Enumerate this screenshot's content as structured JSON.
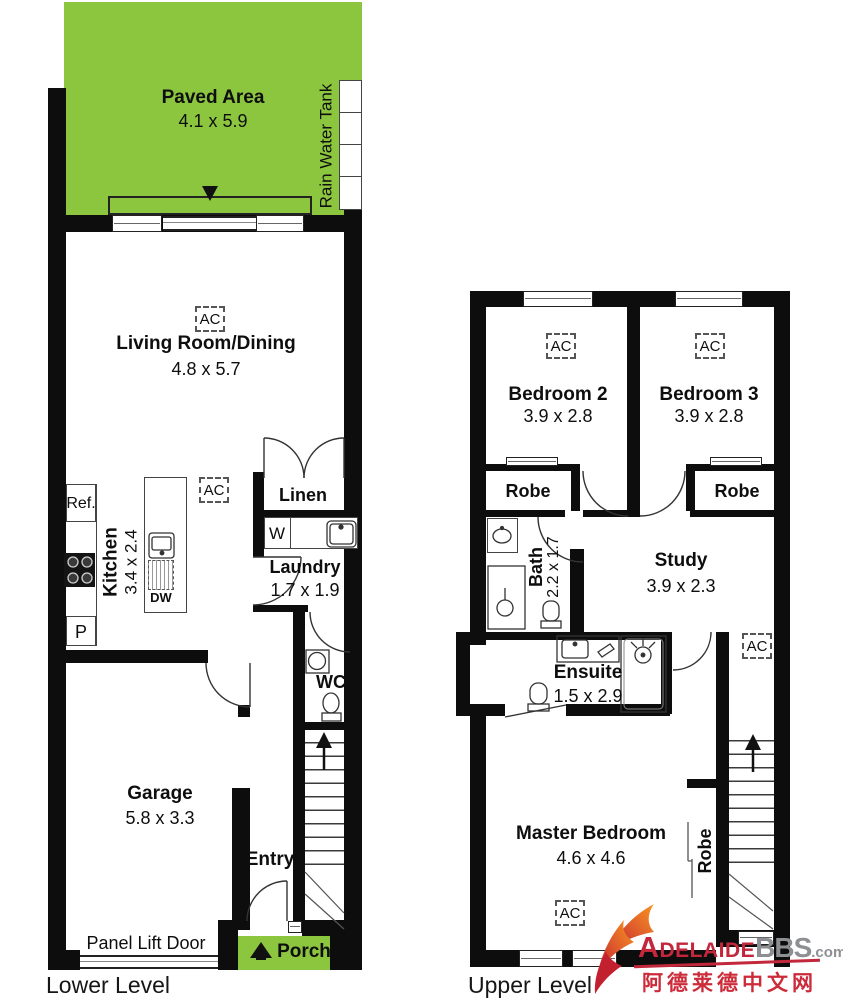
{
  "colors": {
    "green": "#8CC63F",
    "wall": "#0d0d0d",
    "logo_red": "#C2273C",
    "logo_gray": "#8D8F92",
    "chinese_red": "#CC2B3A"
  },
  "shared": {
    "ac_label": "AC"
  },
  "lower": {
    "caption": "Lower Level",
    "paved": {
      "name": "Paved Area",
      "dims": "4.1 x 5.9"
    },
    "tank": {
      "label": "Rain Water Tank"
    },
    "living": {
      "name": "Living Room/Dining",
      "dims": "4.8 x 5.7"
    },
    "kitchen": {
      "name": "Kitchen",
      "dims": "3.4 x 2.4",
      "fridge": "Ref.",
      "pantry": "P",
      "dishwasher": "DW"
    },
    "linen": {
      "name": "Linen"
    },
    "laundry": {
      "name": "Laundry",
      "dims": "1.7 x 1.9",
      "washer": "W"
    },
    "wc": {
      "name": "WC"
    },
    "garage": {
      "name": "Garage",
      "dims": "5.8 x 3.3",
      "door": "Panel Lift Door"
    },
    "entry": {
      "name": "Entry"
    },
    "porch": {
      "name": "Porch"
    }
  },
  "upper": {
    "caption": "Upper Level",
    "bedroom2": {
      "name": "Bedroom 2",
      "dims": "3.9 x 2.8"
    },
    "bedroom3": {
      "name": "Bedroom 3",
      "dims": "3.9 x 2.8"
    },
    "robe_left": {
      "name": "Robe"
    },
    "robe_right": {
      "name": "Robe"
    },
    "bath": {
      "name": "Bath",
      "dims": "2.2 x 1.7"
    },
    "study": {
      "name": "Study",
      "dims": "3.9 x 2.3"
    },
    "ensuite": {
      "name": "Ensuite",
      "dims": "1.5 x 2.9"
    },
    "master": {
      "name": "Master Bedroom",
      "dims": "4.6 x 4.6",
      "robe": "Robe"
    }
  },
  "logo": {
    "brand_primary": "Adelaide",
    "brand_secondary": "BBS",
    "brand_tld": ".com",
    "tagline": "阿德莱德中文网"
  }
}
